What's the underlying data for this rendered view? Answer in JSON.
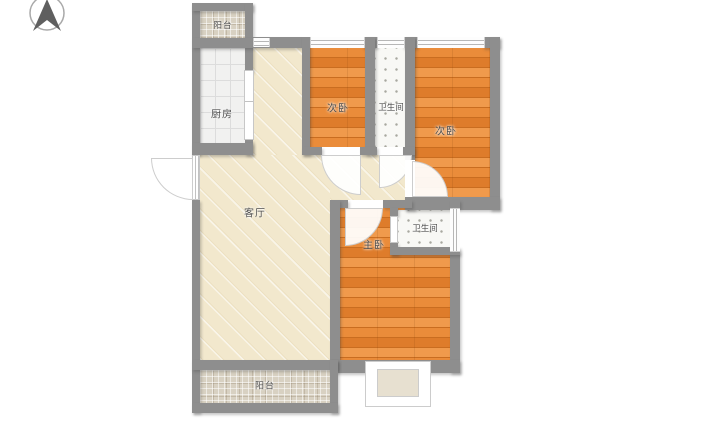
{
  "plan": {
    "type": "apartment-floor-plan",
    "compass_icon": "north-arrow-icon",
    "rooms": {
      "balcony_top": {
        "label": "阳台"
      },
      "kitchen": {
        "label": "厨房"
      },
      "living": {
        "label": "客厅"
      },
      "bedroom_top": {
        "label": "次卧"
      },
      "bath_top": {
        "label": "卫生间"
      },
      "bedroom_right": {
        "label": "次卧"
      },
      "bath_mid": {
        "label": "卫生间"
      },
      "master": {
        "label": "主卧"
      },
      "balcony_bottom": {
        "label": "阳台"
      }
    },
    "colors": {
      "wall": "#8e8e8e",
      "wood_floor": "#e2812f",
      "living_floor": "#f2e8cd",
      "kitchen_tile": "#f1f1f0",
      "bath_tile": "#f8f8f5",
      "balcony_tile": "#d8d1c2"
    }
  }
}
